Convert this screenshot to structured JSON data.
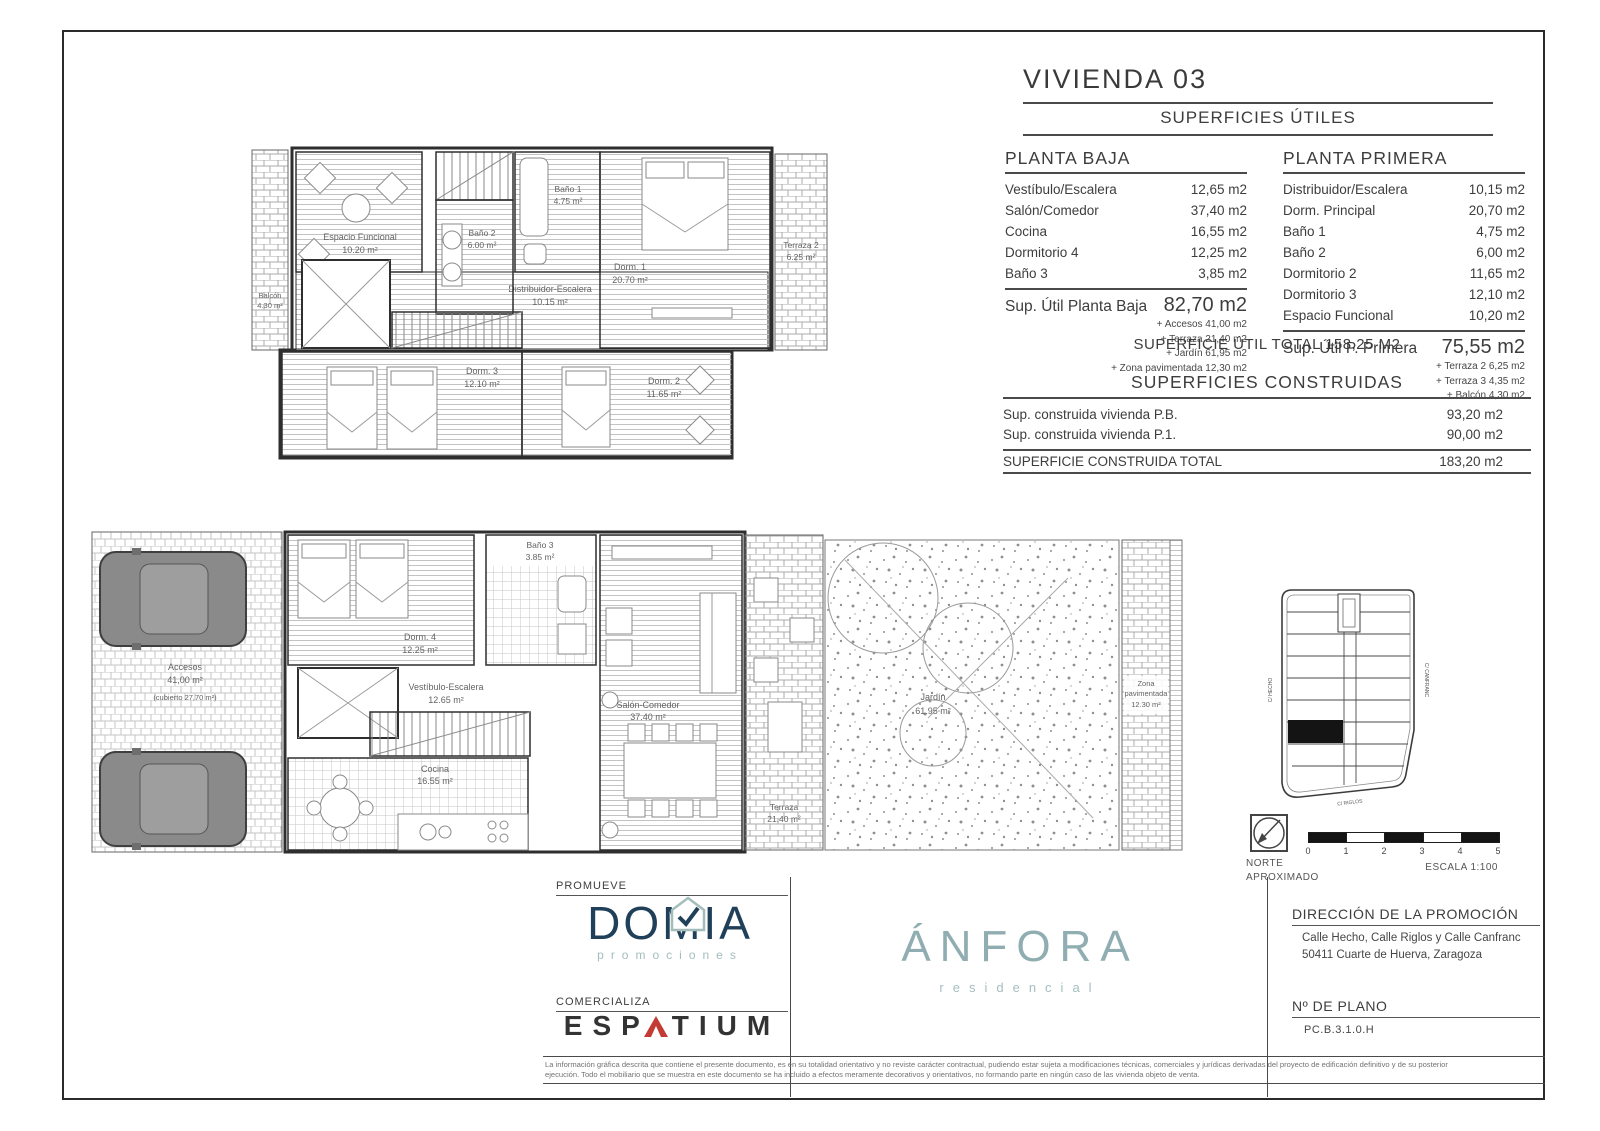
{
  "header": {
    "title": "VIVIENDA 03",
    "subtitle": "SUPERFICIES ÚTILES"
  },
  "planta_baja": {
    "title": "PLANTA BAJA",
    "rows": [
      {
        "label": "Vestíbulo/Escalera",
        "value": "12,65 m2"
      },
      {
        "label": "Salón/Comedor",
        "value": "37,40 m2"
      },
      {
        "label": "Cocina",
        "value": "16,55 m2"
      },
      {
        "label": "Dormitorio 4",
        "value": "12,25 m2"
      },
      {
        "label": "Baño 3",
        "value": "3,85 m2"
      }
    ],
    "total_label": "Sup. Útil Planta Baja",
    "total_value": "82,70 m2",
    "extras": [
      "+ Accesos 41,00 m2",
      "+ Terraza 21,40 m2",
      "+ Jardín 61,95 m2",
      "+ Zona pavimentada 12,30 m2"
    ]
  },
  "planta_primera": {
    "title": "PLANTA PRIMERA",
    "rows": [
      {
        "label": "Distribuidor/Escalera",
        "value": "10,15 m2"
      },
      {
        "label": "Dorm. Principal",
        "value": "20,70 m2"
      },
      {
        "label": "Baño 1",
        "value": "4,75 m2"
      },
      {
        "label": "Baño 2",
        "value": "6,00 m2"
      },
      {
        "label": "Dormitorio 2",
        "value": "11,65 m2"
      },
      {
        "label": "Dormitorio 3",
        "value": "12,10 m2"
      },
      {
        "label": "Espacio Funcional",
        "value": "10,20 m2"
      }
    ],
    "total_label": "Sup. Útil P. Primera",
    "total_value": "75,55 m2",
    "extras": [
      "+ Terraza 2 6,25 m2",
      "+ Terraza 3 4,35 m2",
      "+ Balcón 4,30 m2"
    ]
  },
  "totals": {
    "util_total": "SUPERFICIE ÚTIL TOTAL 158,25 M2"
  },
  "construidas": {
    "title": "SUPERFICIES CONSTRUIDAS",
    "rows": [
      {
        "label": "Sup. construida vivienda P.B.",
        "value": "93,20 m2"
      },
      {
        "label": "Sup. construida vivienda P.1.",
        "value": "90,00 m2"
      }
    ],
    "total_label": "SUPERFICIE CONSTRUIDA TOTAL",
    "total_value": "183,20 m2"
  },
  "plans": {
    "primera": {
      "balcon": [
        "Balcón",
        "4.30 m²"
      ],
      "terraza3": [
        "Terraza 3",
        "4.35 m²"
      ],
      "terraza2": [
        "Terraza 2",
        "6.25 m²"
      ],
      "espacio": [
        "Espacio Funcional",
        "10.20 m²"
      ],
      "bano2": [
        "Baño 2",
        "6.00 m²"
      ],
      "bano1": [
        "Baño 1",
        "4.75 m²"
      ],
      "dorm1": [
        "Dorm. 1",
        "20.70 m²"
      ],
      "distribuidor": [
        "Distribuidor-Escalera",
        "10.15 m²"
      ],
      "dorm3": [
        "Dorm. 3",
        "12.10 m²"
      ],
      "dorm2": [
        "Dorm. 2",
        "11.65 m²"
      ]
    },
    "baja": {
      "accesos": [
        "Accesos",
        "41,00 m²",
        "(cubierto 27,70 m²)"
      ],
      "dorm4": [
        "Dorm. 4",
        "12.25 m²"
      ],
      "bano3": [
        "Baño 3",
        "3.85 m²"
      ],
      "vestibulo": [
        "Vestíbulo-Escalera",
        "12.65 m²"
      ],
      "salon": [
        "Salón-Comedor",
        "37.40 m²"
      ],
      "cocina": [
        "Cocina",
        "16.55 m²"
      ],
      "terraza": [
        "Terraza",
        "21.40 m²"
      ],
      "jardin": [
        "Jardín",
        "61.95 m²"
      ],
      "zona": [
        "Zona",
        "pavimentada",
        "12.30 m²"
      ]
    }
  },
  "sitemap": {
    "streets": [
      "C/ HECHO",
      "C/ CANFRANC",
      "C/ RIGLOS"
    ]
  },
  "compass": {
    "line1": "NORTE",
    "line2": "APROXIMADO"
  },
  "scalebar": {
    "ticks": [
      "0",
      "1",
      "2",
      "3",
      "4",
      "5"
    ],
    "escala": "ESCALA 1:100"
  },
  "branding": {
    "promueve": "PROMUEVE",
    "domia": "DOMIA",
    "domia_sub": "promociones",
    "comercializa": "COMERCIALIZA",
    "espatium_pre": "ESP",
    "espatium_post": "TIUM",
    "anfora": "ÁNFORA",
    "anfora_sub": "residencial"
  },
  "titleblock": {
    "direccion_title": "DIRECCIÓN DE LA PROMOCIÓN",
    "direccion_line1": "Calle Hecho, Calle Riglos y Calle Canfranc",
    "direccion_line2": "50411 Cuarte de Huerva, Zaragoza",
    "plano_title": "Nº DE PLANO",
    "plano_value": "PC.B.3.1.0.H"
  },
  "disclaimer": {
    "line1": "La información gráfica descrita que contiene el presente documento, es en su totalidad orientativo y no reviste carácter contractual, pudiendo estar sujeta a modificaciones técnicas, comerciales y jurídicas derivadas del proyecto de edificación definitivo y de su posterior",
    "line2": "ejecución. Todo el mobiliario que se muestra en este documento se ha incluido a efectos meramente decorativos y orientativos, no formando parte en ningún caso de las vivienda objeto de venta."
  },
  "colors": {
    "domia_navy": "#20405a",
    "domia_teal": "#a3bdbb",
    "espatium_red": "#c23b34",
    "anfora": "#90aeb1",
    "line": "#2b2b2b"
  }
}
